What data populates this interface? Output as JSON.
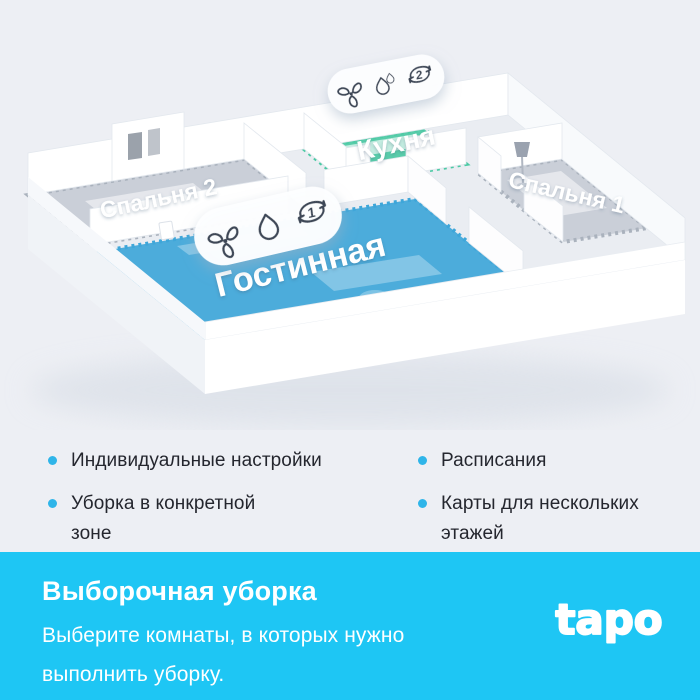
{
  "floorplan": {
    "rooms": {
      "bedroom2": {
        "label": "Спальня 2"
      },
      "kitchen": {
        "label": "Кухня",
        "cycles": "2"
      },
      "bedroom1": {
        "label": "Спальня 1"
      },
      "living": {
        "label": "Гостинная",
        "cycles": "1"
      }
    },
    "colors": {
      "kitchen_highlight": "#4ccaa4",
      "living_highlight": "#3ea6d9",
      "bedroom_floor": "#aab2bd",
      "icon_stroke": "#3d4656"
    }
  },
  "features": {
    "bullet_color": "#2fb5e9",
    "left": [
      "Индивидуальные настройки",
      "Уборка в конкретной\nзоне"
    ],
    "right": [
      "Расписания",
      "Карты для нескольких\nэтажей"
    ]
  },
  "footer": {
    "title": "Выборочная уборка",
    "description": "Выберите комнаты, в которых нужно\nвыполнить уборку.",
    "background": "#1ec6f4",
    "logo_text": "tapo"
  }
}
